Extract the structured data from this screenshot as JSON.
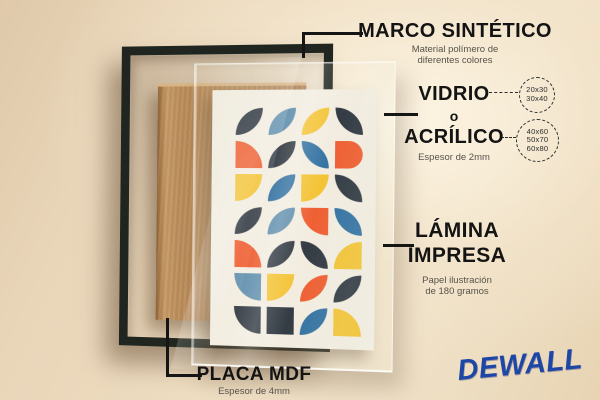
{
  "brand": {
    "name": "DEWALL",
    "color": "#1e46a6"
  },
  "annotations": {
    "marco": {
      "title": "MARCO SINTÉTICO",
      "desc_line1": "Material polímero de",
      "desc_line2": "diferentes colores"
    },
    "vidrio": {
      "word_top": "VIDRIO",
      "word_mid": "o",
      "word_bottom": "ACRÍLICO",
      "desc": "Espesor de 2mm",
      "sizes_small": [
        "20x30",
        "30x40"
      ],
      "sizes_large": [
        "40x60",
        "50x70",
        "60x80"
      ]
    },
    "lamina": {
      "title_line1": "LÁMINA",
      "title_line2": "IMPRESA",
      "desc_line1": "Papel ilustración",
      "desc_line2": "de 180 gramos"
    },
    "placa": {
      "title": "PLACA MDF",
      "desc": "Espesor de 4mm"
    }
  },
  "scene": {
    "frame_color": "#20261f",
    "mdf_color": "#b4875a",
    "poster_bg": "#f2ecdf",
    "palette": {
      "dark": "#2b333c",
      "steel": "#5d8cab",
      "blue": "#2d6d9e",
      "yellow": "#f3c12e",
      "orange": "#ee5a2b"
    },
    "pattern": [
      [
        "dark:tl-br",
        "steel:tl-br",
        "yellow:tl-br",
        "dark:tr-bl"
      ],
      [
        "orange:tr",
        "dark:tl-br",
        "blue:tr-bl",
        "orange:right"
      ],
      [
        "yellow:br",
        "blue:tl-br",
        "yellow:br",
        "dark:tr-bl"
      ],
      [
        "dark:tl-br",
        "steel:tl-br",
        "orange:bl",
        "blue:tr-bl"
      ],
      [
        "orange:tr",
        "dark:tl-br",
        "dark:tr-bl",
        "yellow:tl"
      ],
      [
        "steel:bl",
        "yellow:br",
        "orange:tl-br",
        "dark:tl-br"
      ],
      [
        "dark:bl",
        "dark:none",
        "blue:tl-br",
        "yellow:tr"
      ]
    ]
  }
}
